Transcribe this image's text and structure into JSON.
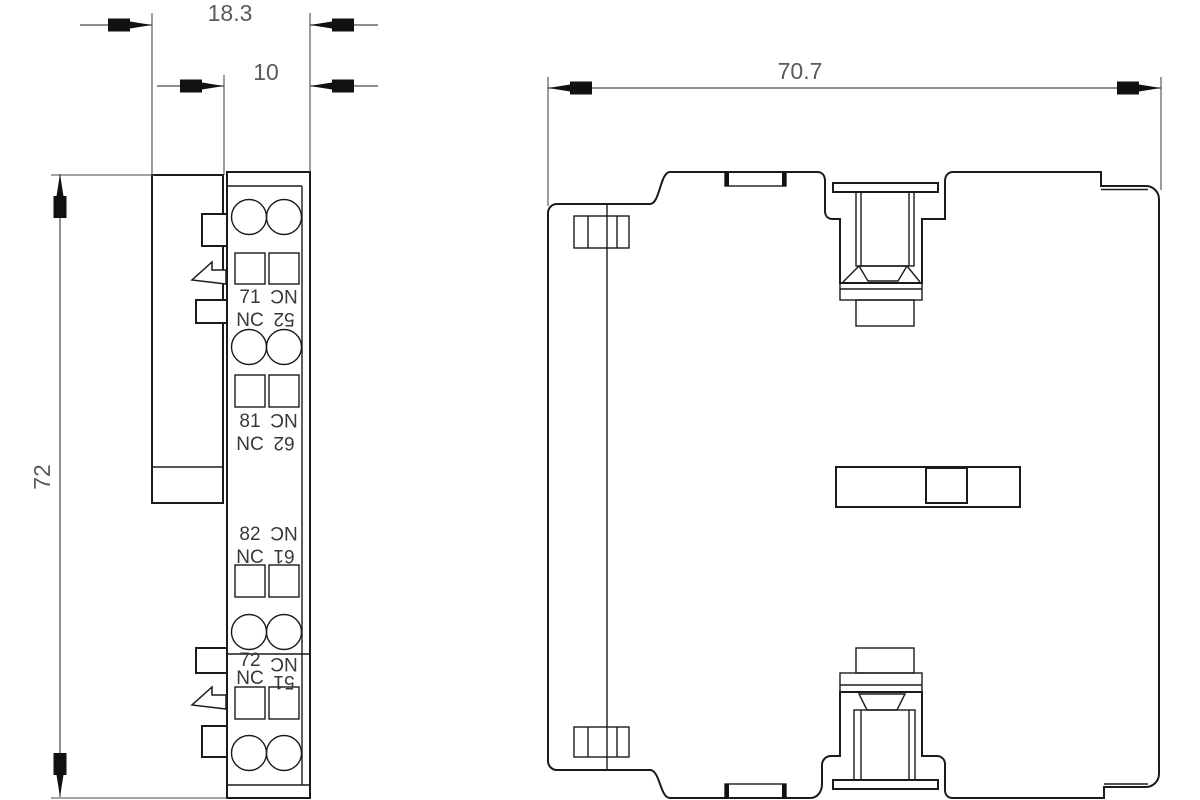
{
  "drawing": {
    "colors": {
      "line": "#1b1b1b",
      "dim_text": "#5a5a5a",
      "label_text": "#383838"
    },
    "side_view": {
      "dims": {
        "overall_width": "18.3",
        "body_width": "10",
        "height": "72"
      },
      "terminal_rows": [
        {
          "left_no": "71",
          "left_type": "NC",
          "right_no": "52",
          "right_type": "NC"
        },
        {
          "left_no": "81",
          "left_type": "NC",
          "right_no": "62",
          "right_type": "NC"
        },
        {
          "left_no": "82",
          "left_type": "NC",
          "right_no": "61",
          "right_type": "NC"
        },
        {
          "left_no": "72",
          "left_type": "NC",
          "right_no": "51",
          "right_type": "NC"
        }
      ]
    },
    "front_view": {
      "dims": {
        "overall_width": "70.7"
      }
    }
  }
}
